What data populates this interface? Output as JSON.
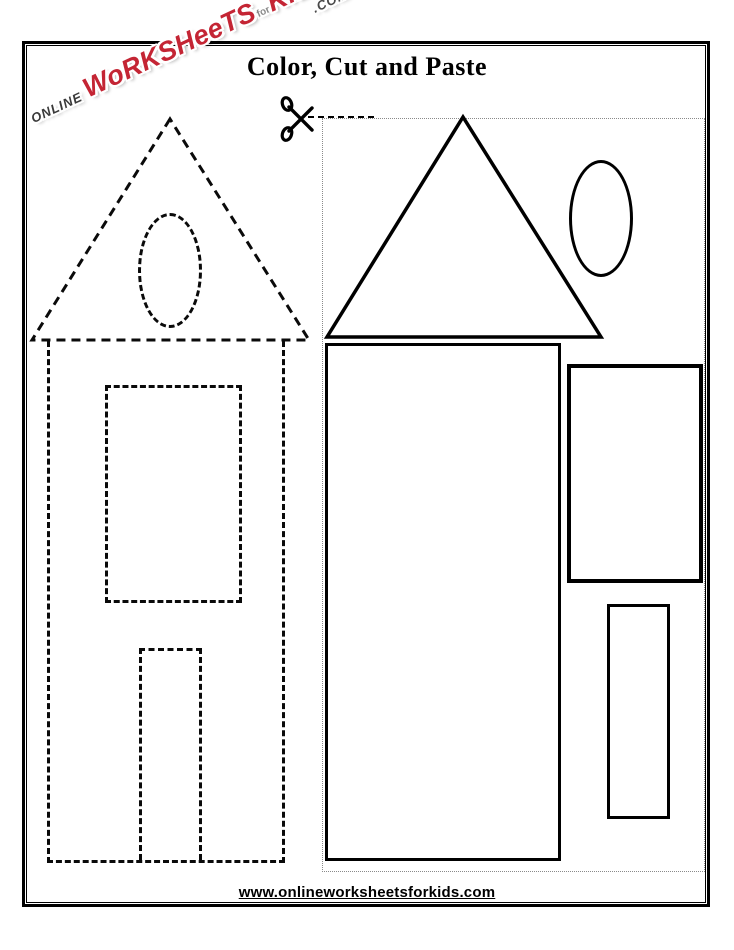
{
  "page": {
    "title": "Color, Cut and Paste",
    "footer_url": "www.onlineworksheetsforkids.com"
  },
  "logo": {
    "online": "ONLINE",
    "brand_main": "WoRKSHeeTS",
    "brand_for": "for",
    "brand_kids": "KIDS",
    "com": ".COM"
  },
  "icons": {
    "scissors": "scissors-icon"
  },
  "worksheet": {
    "left_panel": "house paste-target drawn with dashed outlines",
    "right_panel": "cut-out shapes drawn with solid outlines inside dotted cut region",
    "dashed_shapes": [
      {
        "name": "roof-triangle",
        "style": "dashed"
      },
      {
        "name": "oval-window",
        "style": "dashed"
      },
      {
        "name": "house-body-rectangle",
        "style": "dashed"
      },
      {
        "name": "window-rectangle",
        "style": "dashed"
      },
      {
        "name": "door-rectangle",
        "style": "dashed"
      }
    ],
    "solid_shapes": [
      {
        "name": "roof-triangle",
        "style": "solid"
      },
      {
        "name": "oval-window",
        "style": "solid"
      },
      {
        "name": "house-body-rectangle",
        "style": "solid"
      },
      {
        "name": "window-rectangle",
        "style": "solid"
      },
      {
        "name": "door-rectangle",
        "style": "solid"
      }
    ]
  },
  "colors": {
    "outline": "#000000",
    "brand_red": "#c42534",
    "cut_guide_gray": "#8a8a8a",
    "paper": "#ffffff"
  }
}
